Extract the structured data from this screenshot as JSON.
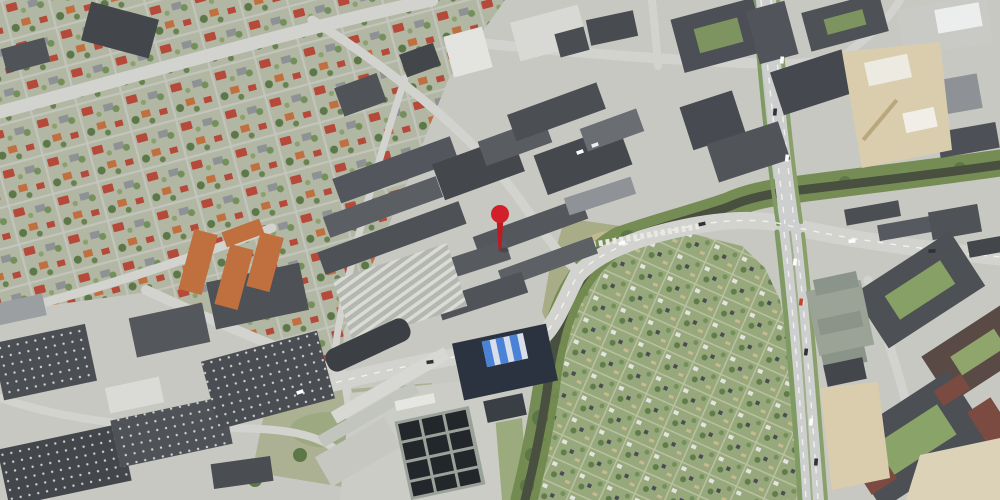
{
  "map": {
    "kind": "aerial-satellite-photo",
    "marker": {
      "type": "location-pin",
      "x": 500,
      "y": 250,
      "head_color": "#d2202a",
      "stem_color": "#bb1c24"
    },
    "palette": {
      "ground": "#c7c8c2",
      "road": "#d2d3ce",
      "road_highway": "#cdcfce",
      "road_marking": "#f4f4f1",
      "residential_base": "#b2b7a4",
      "roof_red": "#b5493a",
      "roof_orange": "#c0703f",
      "roof_dark": "#4b4e53",
      "roof_mid": "#585b60",
      "roof_light": "#9fa3a6",
      "roof_white": "#e6e7e3",
      "vegetation": "#74905a",
      "tree_dark": "#5c7748",
      "grass": "#9cab7d",
      "allotment_base": "#97a97c",
      "water": "#49503f",
      "river_corridor": "#71894f",
      "construction": "#d9cdae",
      "sand": "#dcd2b8",
      "basin_dark": "#23272b",
      "building_navy": "#2b3340",
      "stripe_blue": "#4a82d8"
    }
  }
}
